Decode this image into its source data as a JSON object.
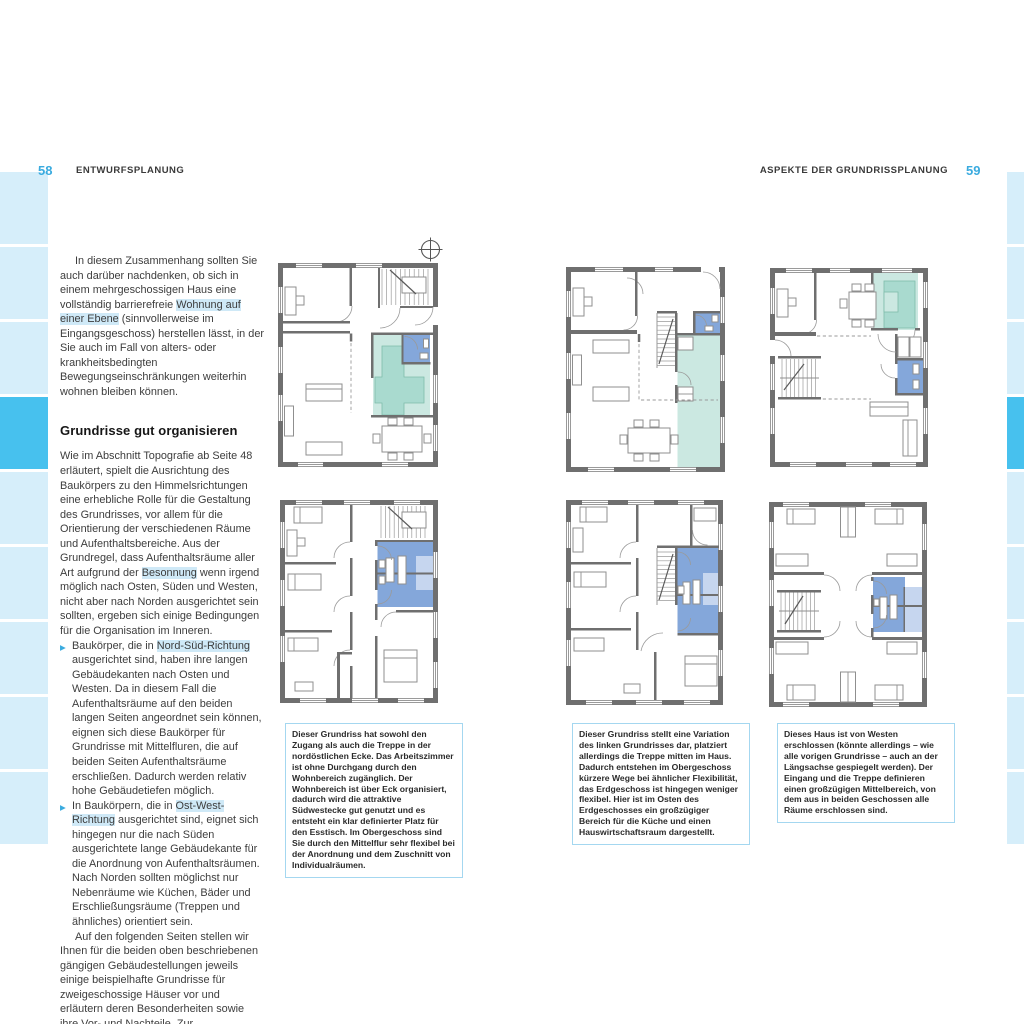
{
  "colors": {
    "accent": "#3aabdf",
    "tab_light": "#d6eefa",
    "tab_active": "#47c1ee",
    "highlight": "#cfe9f7",
    "text": "#3d3d3d",
    "caption_border": "#a4d7f0",
    "wall_gray": "#6f6f6f",
    "teal_light": "#cbe8e1",
    "teal_mid": "#a9dacf",
    "room_blue": "#84a7da",
    "room_blue_light": "#c6d6ef"
  },
  "header": {
    "left_page_number": "58",
    "left_title": "ENTWURFSPLANUNG",
    "right_title": "ASPEKTE DER GRUNDRISSPLANUNG",
    "right_page_number": "59"
  },
  "edge_tabs": {
    "left": [
      "light",
      "light",
      "light",
      "active",
      "light",
      "light",
      "light",
      "light",
      "light"
    ],
    "right": [
      "light",
      "light",
      "light",
      "active",
      "light",
      "light",
      "light",
      "light",
      "light"
    ]
  },
  "article": {
    "bullet_glyph": "▶",
    "para1": [
      {
        "t": "In diesem Zusammenhang sollten Sie auch darüber nachdenken, ob sich in einem mehrgeschossigen Haus eine vollständig barrierefreie ",
        "h": false
      },
      {
        "t": "Wohnung auf einer Ebene",
        "h": true
      },
      {
        "t": " (sinnvollerweise im Eingangsgeschoss) herstellen lässt, in der Sie auch im Fall von alters- oder krankheitsbedingten Bewegungseinschränkungen weiterhin wohnen bleiben können.",
        "h": false
      }
    ],
    "heading": "Grundrisse gut organisieren",
    "para2": [
      {
        "t": "Wie im Abschnitt Topografie ab Seite 48 erläutert, spielt die Ausrichtung des Baukörpers zu den Himmelsrichtungen eine erhebliche Rolle für die Gestaltung des Grundrisses, vor allem für die Orientierung der verschiedenen Räume und Aufenthaltsbereiche. Aus der Grundregel, dass Aufenthaltsräume aller Art aufgrund der ",
        "h": false
      },
      {
        "t": "Besonnung",
        "h": true
      },
      {
        "t": " wenn irgend möglich nach Osten, Süden und Westen, nicht aber nach Norden ausgerichtet sein sollten, ergeben sich einige Bedingungen für die Organisation im Inneren.",
        "h": false
      }
    ],
    "bullet1": [
      {
        "t": "Baukörper, die in ",
        "h": false
      },
      {
        "t": "Nord-Süd-Richtung",
        "h": true
      },
      {
        "t": " ausgerichtet sind, haben ihre langen Gebäudekanten nach Osten und Westen. Da in diesem Fall die Aufenthaltsräume auf den beiden langen Seiten angeordnet sein können, eignen sich diese Baukörper für Grundrisse mit Mittelfluren, die auf beiden Seiten Aufenthaltsräume erschließen. Dadurch werden relativ hohe Gebäudetiefen möglich.",
        "h": false
      }
    ],
    "bullet2": [
      {
        "t": "In Baukörpern, die in ",
        "h": false
      },
      {
        "t": "Ost-West-Richtung",
        "h": true
      },
      {
        "t": " ausgerichtet sind, eignet sich hingegen nur die nach Süden ausgerichtete lange Gebäudekante für die Anordnung von Aufenthaltsräumen. Nach Norden sollten möglichst nur Nebenräume wie Küchen, Bäder und Erschließungsräume (Treppen und ähnliches) orientiert sein.",
        "h": false
      }
    ],
    "para3": "Auf den folgenden Seiten stellen wir Ihnen für die beiden oben beschriebenen gängigen Gebäudestellungen jeweils einige beispielhafte Grundrisse für zweigeschossige Häuser vor und erläutern deren Besonderheiten sowie ihre Vor- und Nachteile. Zur"
  },
  "captions": [
    "Dieser Grundriss hat sowohl den Zugang als auch die Treppe in der nordöstlichen Ecke. Das Arbeitszimmer ist ohne Durchgang durch den Wohnbereich zugänglich. Der Wohnbereich ist über Eck organisiert, dadurch wird die attraktive Südwestecke gut genutzt und es entsteht ein klar definierter Platz für den Esstisch. Im Obergeschoss sind Sie durch den Mittelflur sehr flexibel bei der Anordnung und dem Zuschnitt von Individualräumen.",
    "Dieser Grundriss stellt eine Variation des linken Grundrisses dar, platziert allerdings die Treppe mitten im Haus. Dadurch entstehen im Obergeschoss kürzere Wege bei ähnlicher Flexibilität, das Erdgeschoss ist hingegen weniger flexibel. Hier ist im Osten des Erdgeschosses ein großzügiger Bereich für die Küche und einen Hauswirtschaftsraum dargestellt.",
    "Dieses Haus ist von Westen erschlossen (könnte allerdings – wie alle vorigen Grundrisse – auch an der Längsachse gespiegelt werden). Der Eingang und die Treppe definieren einen großzügigen Mittelbereich, von dem aus in beiden Geschossen alle Räume erschlossen sind."
  ]
}
